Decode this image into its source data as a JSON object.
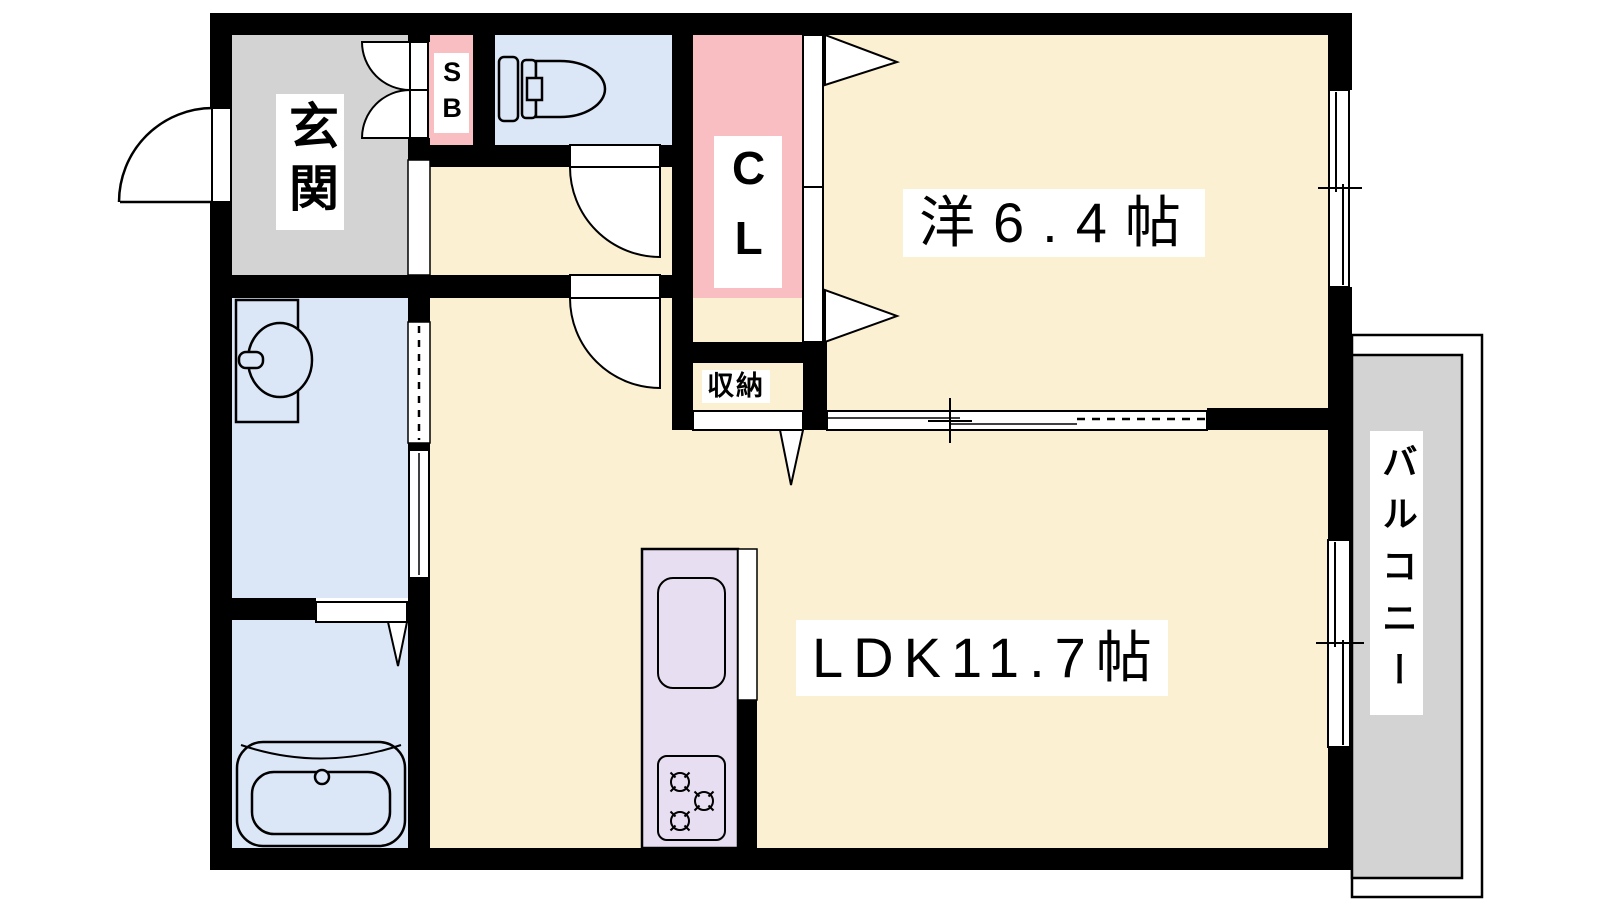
{
  "floorplan": {
    "type": "apartment-floor-plan",
    "labels": {
      "genkan": "玄関",
      "shoe_box": "SB",
      "closet": "CL",
      "western_room": "洋6.4帖",
      "storage": "収納",
      "ldk": "LDK11.7帖",
      "balcony": "バルコニー"
    },
    "colors": {
      "wall": "#000000",
      "floor_cream": "#fcf0d3",
      "wet_blue": "#dbe7f7",
      "pink": "#f9bec2",
      "genkan_gray": "#d3d3d3",
      "kitchen_lavender": "#e7def1",
      "balcony_gray": "#d3d3d3",
      "label_bg": "#ffffff"
    }
  }
}
